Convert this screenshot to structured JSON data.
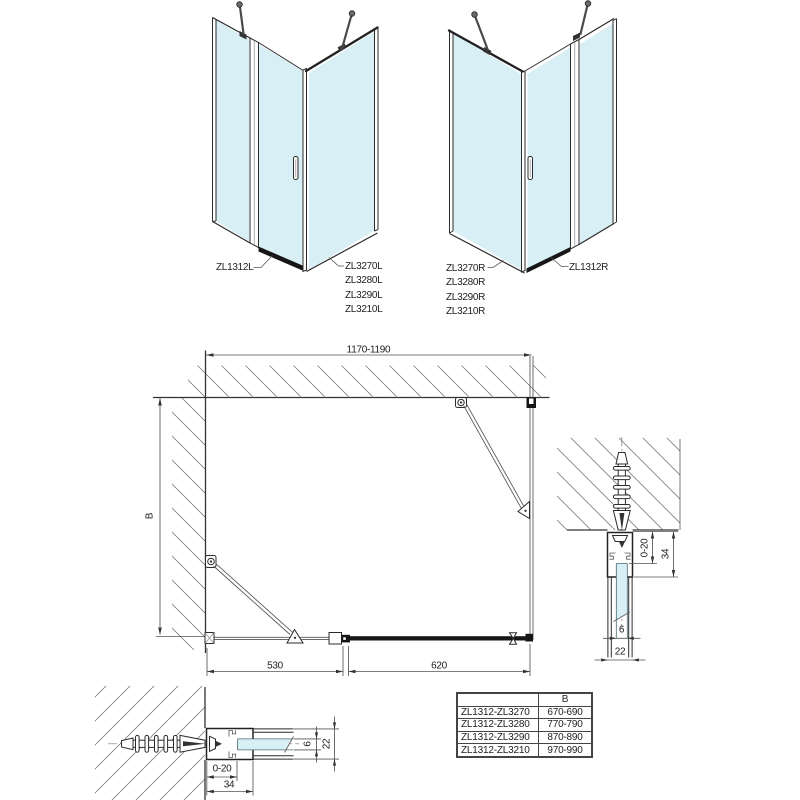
{
  "drawing": {
    "iso_left": {
      "front_label": "ZL1312L",
      "side_labels": [
        "ZL3270L",
        "ZL3280L",
        "ZL3290L",
        "ZL3210L"
      ]
    },
    "iso_right": {
      "side_labels": [
        "ZL3270R",
        "ZL3280R",
        "ZL3290R",
        "ZL3210R"
      ],
      "front_label": "ZL1312R"
    },
    "plan": {
      "width": "1170-1190",
      "depth": "B",
      "fixed_segment": "530",
      "door_segment": "620"
    },
    "section_side": {
      "adjustment": "0-20",
      "profile_depth": "34",
      "glass_thickness": "6",
      "profile_width": "22"
    },
    "section_bottom": {
      "adjustment": "0-20",
      "profile_depth": "34",
      "glass_thickness": "6",
      "profile_width": "22"
    },
    "size_table": {
      "col_b_header": "B",
      "rows": [
        {
          "combination": "ZL1312-ZL3270",
          "b_range": "670-690"
        },
        {
          "combination": "ZL1312-ZL3280",
          "b_range": "770-790"
        },
        {
          "combination": "ZL1312-ZL3290",
          "b_range": "870-890"
        },
        {
          "combination": "ZL1312-ZL3210",
          "b_range": "970-990"
        }
      ]
    }
  },
  "colors": {
    "glass": "#d9eff6",
    "line": "#2b2b2b",
    "hatch": "#838383",
    "dim": "#555555"
  }
}
